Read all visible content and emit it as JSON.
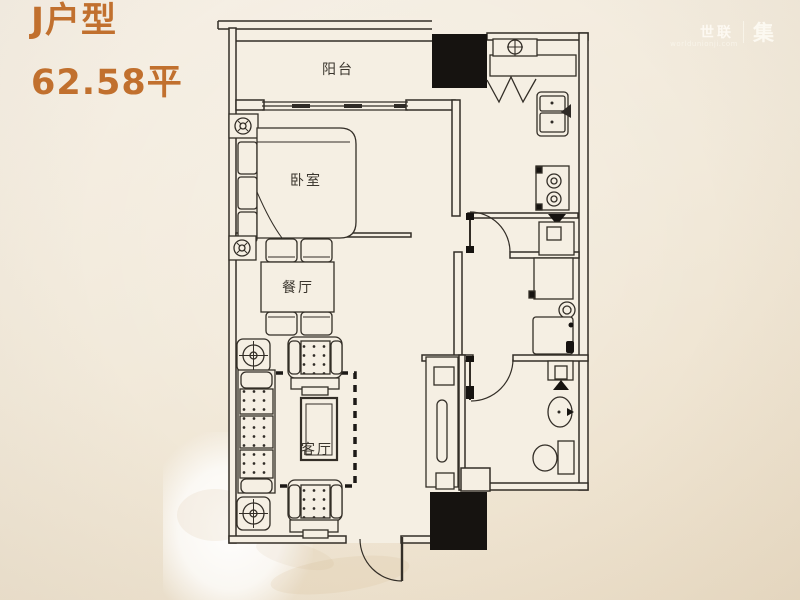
{
  "title": {
    "unit_name": "J户型",
    "area": "62.58平"
  },
  "watermark": {
    "brand_left": "世联",
    "brand_right": "集",
    "url": "worldunionji.com"
  },
  "rooms": {
    "balcony": "阳台",
    "bedroom": "卧室",
    "dining": "餐厅",
    "living": "客厅"
  },
  "colors": {
    "title_text": "#c1702e",
    "wall_line": "#332e27",
    "solid_column": "#161310",
    "floor_fill": "#f5efe3",
    "background": "#f2eadb"
  },
  "fixture_icons": [
    "gas-meter-icon",
    "folding-door-icon",
    "kitchen-sink-icon",
    "two-burner-stove-icon",
    "refrigerator-icon",
    "storage-cabinet-icon",
    "washing-machine-icon",
    "water-heater-icon",
    "wash-basin-icon",
    "toilet-icon",
    "bed-icon",
    "wardrobe-icon",
    "dining-table-icon",
    "dining-chair-icon",
    "sofa-icon",
    "armchair-icon",
    "coffee-table-icon",
    "tv-cabinet-icon",
    "carpet-outline-icon",
    "column-marker-icon",
    "ceiling-fixture-icon",
    "door-swing-icon"
  ]
}
